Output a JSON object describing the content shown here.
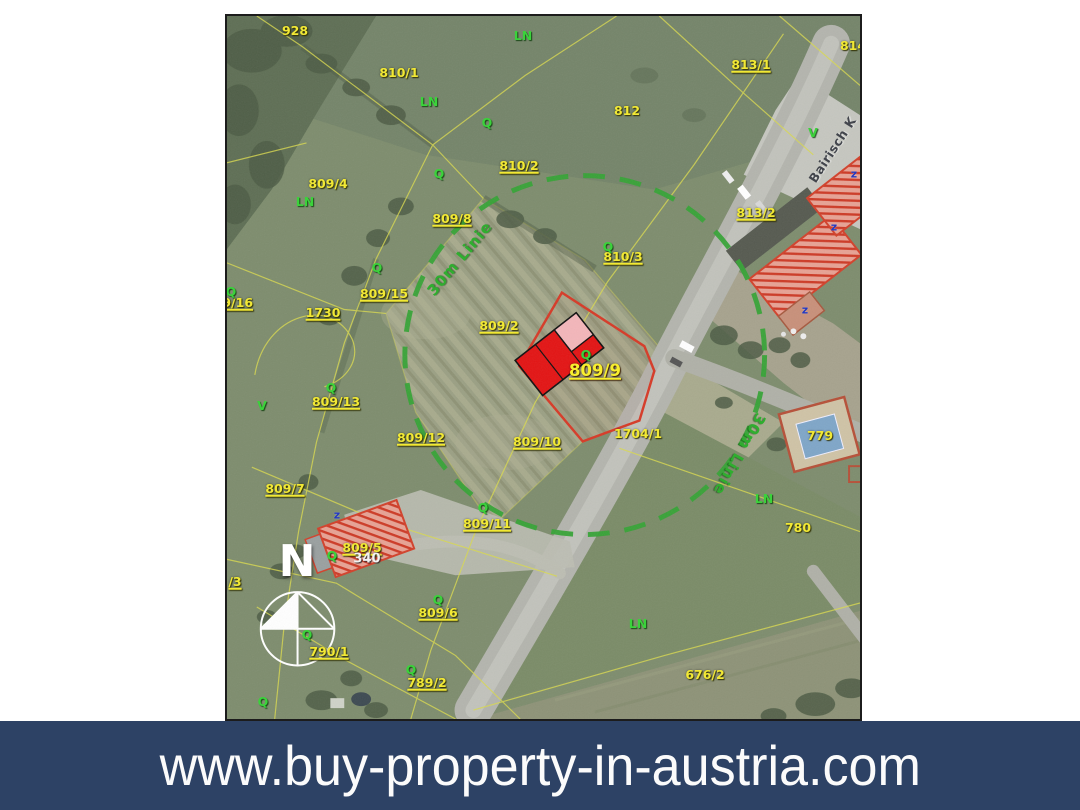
{
  "banner": {
    "url": "www.buy-property-in-austria.com"
  },
  "map": {
    "street_name": "Bairisch K",
    "target_parcel": "809/9",
    "radius_label": "30m Linie",
    "north_letter": "N",
    "house_number": "340",
    "colors": {
      "banner_bg": "#2d4265",
      "label_yellow": "#f2e935",
      "land_use_green": "#3bd23b",
      "radius_circle_green": "#36a336",
      "highlight_red": "#d63a27",
      "building_red": "#e31414",
      "building_pink": "#f3b6ba"
    },
    "labels": [
      {
        "text": "928",
        "x": 68,
        "y": 15,
        "kind": "y"
      },
      {
        "text": "810/1",
        "x": 172,
        "y": 57,
        "kind": "y"
      },
      {
        "text": "812",
        "x": 400,
        "y": 95,
        "kind": "y"
      },
      {
        "text": "813/1",
        "x": 524,
        "y": 49,
        "kind": "y",
        "u": true
      },
      {
        "text": "814",
        "x": 626,
        "y": 30,
        "kind": "y"
      },
      {
        "text": "810/2",
        "x": 292,
        "y": 150,
        "kind": "y",
        "u": true
      },
      {
        "text": "809/4",
        "x": 101,
        "y": 168,
        "kind": "y"
      },
      {
        "text": "809/8",
        "x": 225,
        "y": 203,
        "kind": "y",
        "u": true
      },
      {
        "text": "813/2",
        "x": 529,
        "y": 197,
        "kind": "y",
        "u": true
      },
      {
        "text": "810/3",
        "x": 396,
        "y": 241,
        "kind": "y",
        "u": true
      },
      {
        "text": "809/15",
        "x": 157,
        "y": 278,
        "kind": "y",
        "u": true
      },
      {
        "text": "809/16",
        "x": 2,
        "y": 287,
        "kind": "y",
        "u": true
      },
      {
        "text": "1730",
        "x": 96,
        "y": 297,
        "kind": "y",
        "u": true
      },
      {
        "text": "809/2",
        "x": 272,
        "y": 310,
        "kind": "y",
        "u": true
      },
      {
        "text": "809/9",
        "x": 368,
        "y": 355,
        "kind": "ym",
        "u": true
      },
      {
        "text": "809/13",
        "x": 109,
        "y": 386,
        "kind": "y",
        "u": true
      },
      {
        "text": "809/12",
        "x": 194,
        "y": 422,
        "kind": "y",
        "u": true
      },
      {
        "text": "809/10",
        "x": 310,
        "y": 426,
        "kind": "y",
        "u": true
      },
      {
        "text": "1704/1",
        "x": 411,
        "y": 418,
        "kind": "y"
      },
      {
        "text": "779",
        "x": 593,
        "y": 420,
        "kind": "y"
      },
      {
        "text": "809/7",
        "x": 58,
        "y": 473,
        "kind": "y",
        "u": true
      },
      {
        "text": "809/11",
        "x": 260,
        "y": 508,
        "kind": "y",
        "u": true
      },
      {
        "text": "780",
        "x": 571,
        "y": 512,
        "kind": "y"
      },
      {
        "text": "809/5",
        "x": 135,
        "y": 532,
        "kind": "y",
        "u": true
      },
      {
        "text": "/3",
        "x": 8,
        "y": 566,
        "kind": "y",
        "u": true
      },
      {
        "text": "809/6",
        "x": 211,
        "y": 597,
        "kind": "y",
        "u": true
      },
      {
        "text": "790/1",
        "x": 102,
        "y": 636,
        "kind": "y",
        "u": true
      },
      {
        "text": "789/2",
        "x": 200,
        "y": 667,
        "kind": "y",
        "u": true
      },
      {
        "text": "676/2",
        "x": 478,
        "y": 659,
        "kind": "y"
      },
      {
        "text": "LN",
        "x": 296,
        "y": 20,
        "kind": "g"
      },
      {
        "text": "LN",
        "x": 202,
        "y": 86,
        "kind": "g"
      },
      {
        "text": "LN",
        "x": 78,
        "y": 186,
        "kind": "g"
      },
      {
        "text": "LN",
        "x": 537,
        "y": 483,
        "kind": "g"
      },
      {
        "text": "LN",
        "x": 411,
        "y": 608,
        "kind": "g"
      },
      {
        "text": "Q",
        "x": 260,
        "y": 107,
        "kind": "g"
      },
      {
        "text": "Q",
        "x": 212,
        "y": 158,
        "kind": "g"
      },
      {
        "text": "Q",
        "x": 381,
        "y": 231,
        "kind": "g"
      },
      {
        "text": "Q",
        "x": 150,
        "y": 252,
        "kind": "g"
      },
      {
        "text": "Q",
        "x": 4,
        "y": 276,
        "kind": "g"
      },
      {
        "text": "Q",
        "x": 359,
        "y": 339,
        "kind": "g"
      },
      {
        "text": "Q",
        "x": 104,
        "y": 372,
        "kind": "g"
      },
      {
        "text": "Q",
        "x": 256,
        "y": 492,
        "kind": "g"
      },
      {
        "text": "Q",
        "x": 105,
        "y": 540,
        "kind": "g"
      },
      {
        "text": "Q",
        "x": 211,
        "y": 584,
        "kind": "g"
      },
      {
        "text": "Q",
        "x": 80,
        "y": 619,
        "kind": "g"
      },
      {
        "text": "Q",
        "x": 184,
        "y": 654,
        "kind": "g"
      },
      {
        "text": "Q",
        "x": 36,
        "y": 686,
        "kind": "g"
      },
      {
        "text": "V",
        "x": 35,
        "y": 390,
        "kind": "g"
      },
      {
        "text": "V",
        "x": 586,
        "y": 117,
        "kind": "g"
      },
      {
        "text": "N",
        "x": 70,
        "y": 546,
        "kind": "n"
      },
      {
        "text": "340",
        "x": 140,
        "y": 543,
        "kind": "w"
      },
      {
        "text": "z",
        "x": 578,
        "y": 294,
        "kind": "b"
      },
      {
        "text": "z",
        "x": 607,
        "y": 211,
        "kind": "b"
      },
      {
        "text": "z",
        "x": 627,
        "y": 158,
        "kind": "b"
      },
      {
        "text": "z",
        "x": 110,
        "y": 499,
        "kind": "b"
      },
      {
        "text": "Bairisch K",
        "x": 606,
        "y": 134,
        "kind": "st",
        "rot": -57
      },
      {
        "text": "30m Linie",
        "x": 233,
        "y": 243,
        "kind": "c",
        "rot": -50
      },
      {
        "text": "30m Linie",
        "x": 512,
        "y": 438,
        "kind": "c",
        "rot": 119
      }
    ]
  }
}
